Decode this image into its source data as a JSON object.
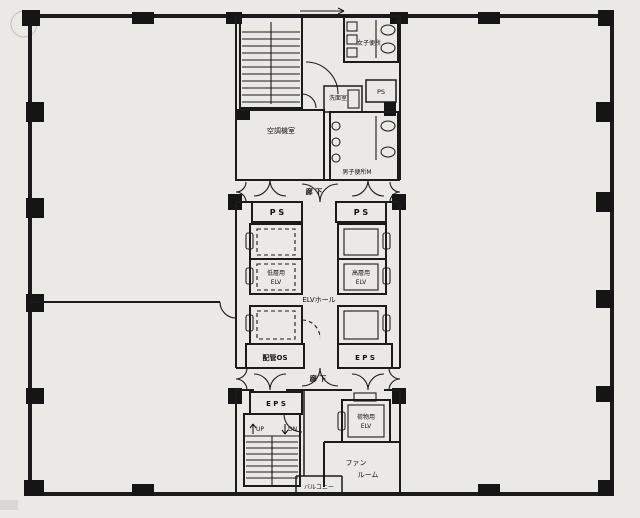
{
  "document": {
    "kind": "scanned building floor plan",
    "colors": {
      "ink": "#1b1b1b",
      "paper": "#eae9e5"
    }
  },
  "labels": {
    "womens_wc": "女子便所",
    "ps_top": "PS",
    "washroom": "洗面室",
    "mens_wc": "男子便所M",
    "machine_room": "空調機室",
    "corridor_upper": "廊 下",
    "ps_left": "P S",
    "ps_right": "P S",
    "elv_low_1": "低層用",
    "elv_low_2": "ELV",
    "elv_high_1": "高層用",
    "elv_high_2": "ELV",
    "elv_hall": "ELVホール",
    "pipe_os": "配管OS",
    "eps_right": "E P S",
    "corridor_lower": "廊 下",
    "eps_left": "E P S",
    "stairs_up": "UP",
    "stairs_dn": "DN",
    "freight_1": "荷物用",
    "freight_2": "ELV",
    "fan_1": "ファン",
    "fan_2": "ルーム",
    "balcony": "バルコニー"
  }
}
